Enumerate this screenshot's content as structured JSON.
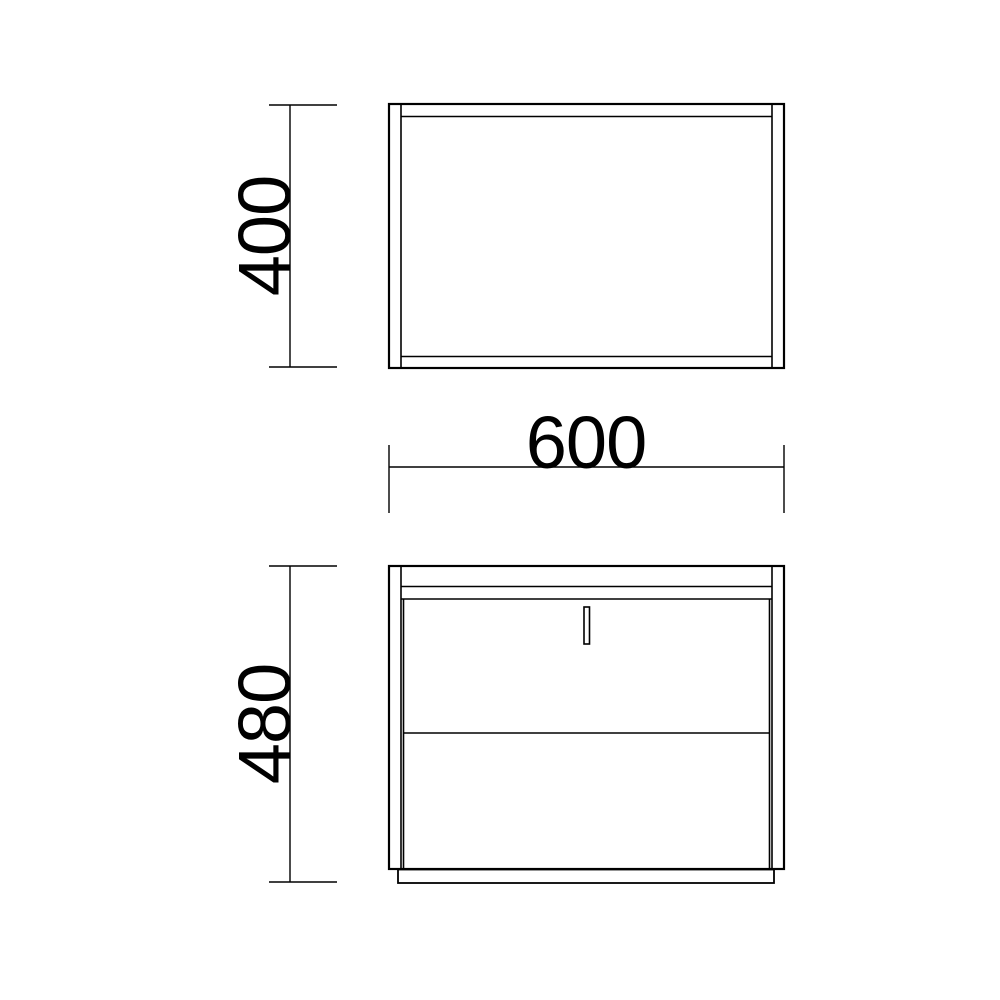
{
  "drawing": {
    "background_color": "#ffffff",
    "line_color": "#000000",
    "dimensions": {
      "depth": "400",
      "width": "600",
      "height": "480"
    }
  }
}
